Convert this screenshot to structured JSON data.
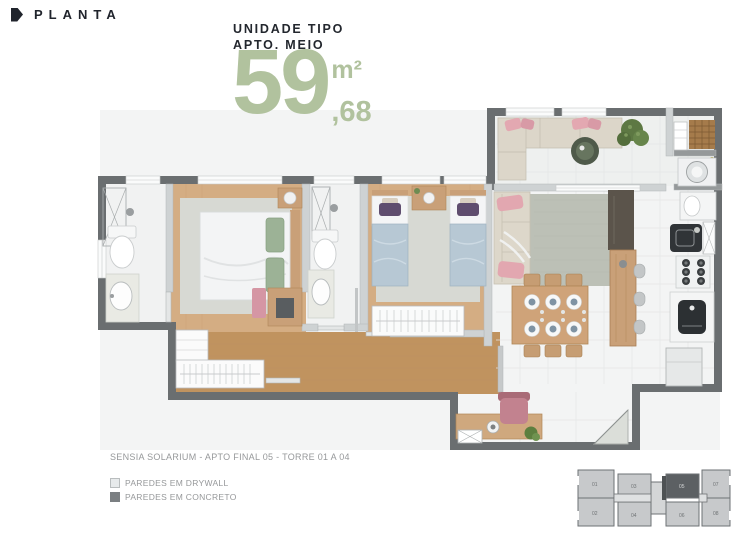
{
  "header": {
    "title": "PLANTA"
  },
  "unit_info": {
    "line1": "UNIDADE TIPO",
    "line2": "APTO. MEIO",
    "area_integer": "59",
    "area_unit": "m²",
    "area_decimal": ",68"
  },
  "caption": "SENSIA SOLARIUM - APTO FINAL 05 - TORRE 01 A 04",
  "legend": {
    "items": [
      {
        "label": "PAREDES EM DRYWALL",
        "swatch": "#e7eaeb"
      },
      {
        "label": "PAREDES EM CONCRETO",
        "swatch": "#7b7f82"
      }
    ]
  },
  "keyplan": {
    "units": [
      "01",
      "03",
      "05",
      "07",
      "02",
      "04",
      "06",
      "08"
    ],
    "highlighted_unit": "05"
  },
  "colors": {
    "accent_green": "#b1c29e",
    "heading": "#20242c",
    "caption_gray": "#96989a",
    "wall_concrete": "#6a6e70",
    "wall_drywall": "#ced2d3",
    "wood_floor": "#d2ab80",
    "keyplan_highlight": "#5c6063"
  }
}
